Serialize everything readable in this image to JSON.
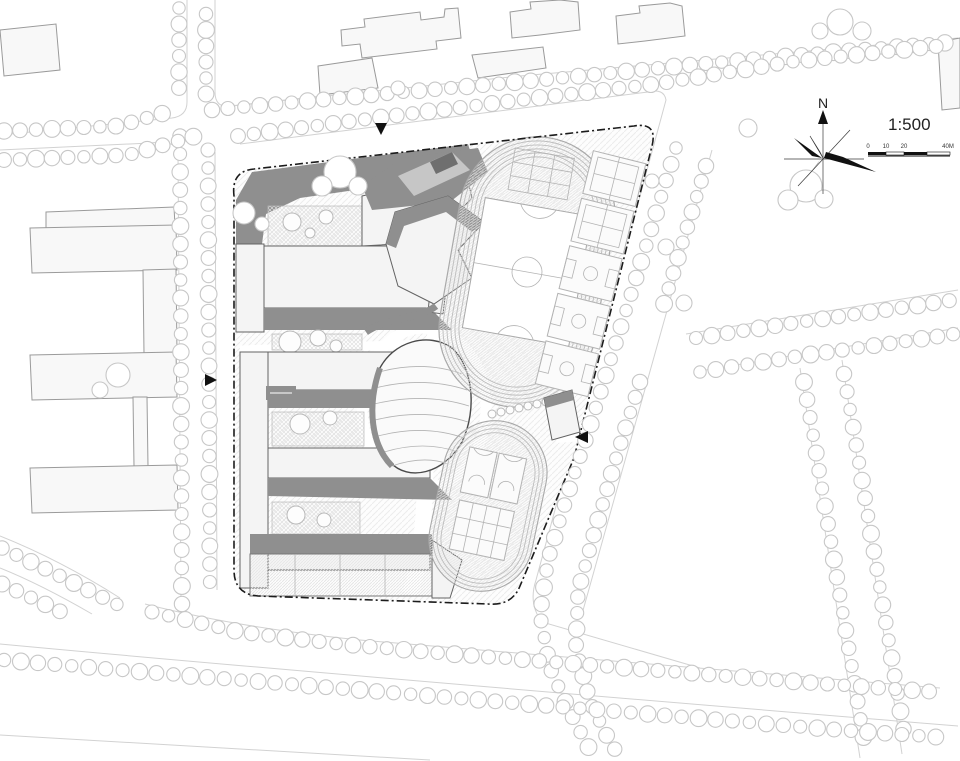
{
  "plan": {
    "compass": {
      "north_label": "N"
    },
    "scale_bar": {
      "ratio": "1:500",
      "ticks": [
        "0",
        "10",
        "20",
        "40M"
      ]
    }
  },
  "icons": {
    "north_compass": "compass-rose-icon",
    "entrance_marker": "entrance-arrow-icon",
    "tree": "tree-circle-icon"
  },
  "colors": {
    "background": "#ffffff",
    "site_boundary": "#1c1c1c",
    "building_shadow": "#8f8f8f",
    "building_roof": "#f4f4f4",
    "context_building": "#f8f8f8",
    "context_outline": "#9a9a9a",
    "tree_outline": "#c7c7c7",
    "road_line": "#d2d2d2",
    "sport_line": "#b3b3b3",
    "marker_black": "#111111"
  }
}
